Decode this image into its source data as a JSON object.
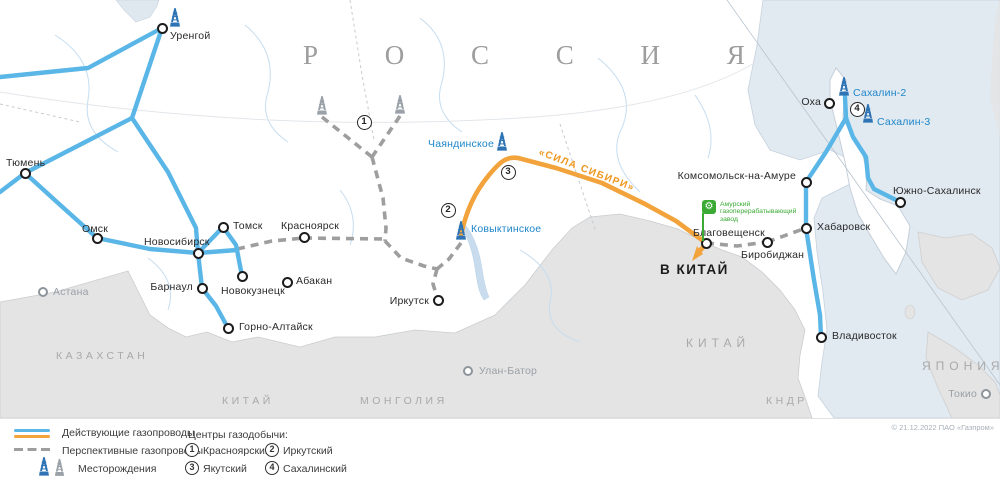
{
  "map": {
    "regions": {
      "russia": "Р О С С И Я",
      "kazakhstan": "КАЗАХСТАН",
      "mongolia": "МОНГОЛИЯ",
      "china": "КИТАЙ",
      "dprk": "КНДР",
      "japan": "ЯПОНИЯ"
    },
    "cities": [
      "Уренгой",
      "Тюмень",
      "Омск",
      "Новосибирск",
      "Томск",
      "Красноярск",
      "Барнаул",
      "Новокузнецк",
      "Абакан",
      "Горно-Алтайск",
      "Иркутск",
      "Комсомольск-на-Амуре",
      "Благовещенск",
      "Биробиджан",
      "Хабаровск",
      "Владивосток",
      "Южно-Сахалинск",
      "Оха"
    ],
    "foreign_cities": [
      "Астана",
      "Улан-Батор",
      "Токио"
    ],
    "fields": [
      "Чаяндинское",
      "Ковыктинское",
      "Сахалин-2",
      "Сахалин-3"
    ],
    "pipeline_name": "«СИЛА СИБИРИ»",
    "to_china": "В КИТАЙ",
    "plant": "Амурский газоперерабатывающий завод",
    "center_markers": [
      "1",
      "2",
      "3",
      "4"
    ]
  },
  "legend": {
    "existing": "Действующие газопроводы",
    "prospective": "Перспективные газопроводы",
    "fields": "Месторождения",
    "centers_title": "Центры газодобычи:",
    "centers": [
      {
        "num": "1",
        "name": "Красноярский"
      },
      {
        "num": "2",
        "name": "Иркутский"
      },
      {
        "num": "3",
        "name": "Якутский"
      },
      {
        "num": "4",
        "name": "Сахалинский"
      }
    ]
  },
  "copyright": "© 21.12.2022 ПАО «Газпром»",
  "colors": {
    "existing_pipeline": "#5ab6e7",
    "power_of_siberia": "#f2a33c",
    "prospective_pipeline": "#9e9e9e",
    "field_derrick_blue": "#2e74b5",
    "plant_green": "#3aaa35",
    "sea": "#e1e9f1",
    "foreign_land": "#e4e4e4"
  }
}
